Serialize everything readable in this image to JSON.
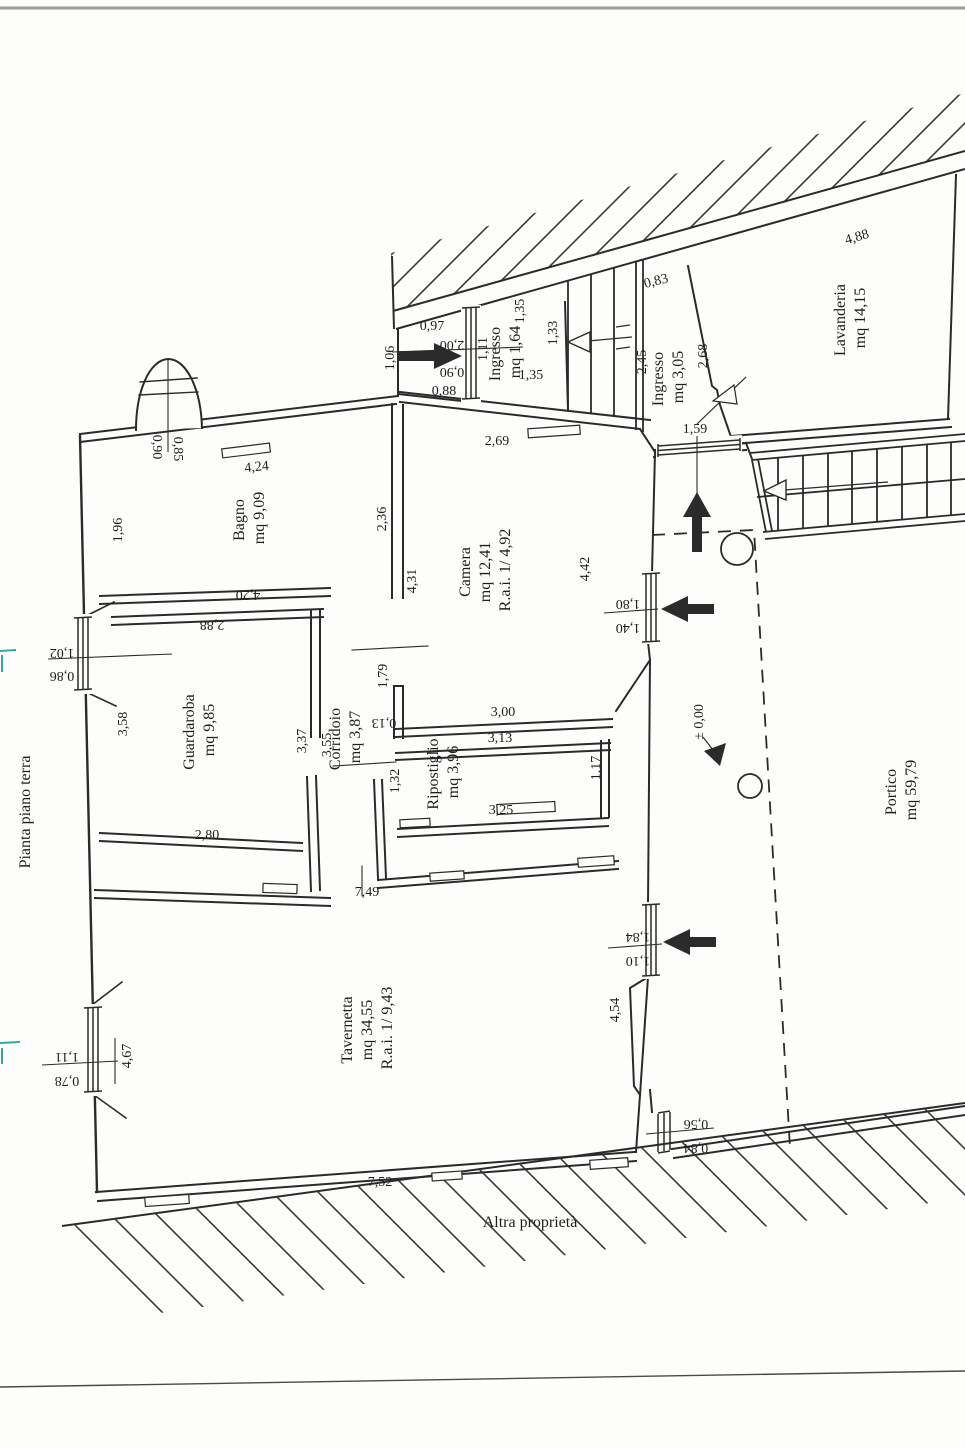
{
  "colors": {
    "ink": "#2b2b2b",
    "paper": "#fdfdfb",
    "teal_mark": "#35a8a1"
  },
  "title": "Pianta piano terra",
  "site_label": "Altra proprietà",
  "level_marker": "± 0,00",
  "rooms": {
    "ingresso_small": {
      "name": "Ingresso",
      "area": "mq 1,64"
    },
    "ingresso_main": {
      "name": "Ingresso",
      "area": "mq 3,05"
    },
    "lavanderia": {
      "name": "Lavanderia",
      "area": "mq 14,15"
    },
    "bagno": {
      "name": "Bagno",
      "area": "mq 9,09"
    },
    "camera": {
      "name": "Camera",
      "area": "mq 12,41",
      "rai": "R.a.i. 1/ 4,92"
    },
    "guardaroba": {
      "name": "Guardaroba",
      "area": "mq 9,85"
    },
    "corridoio": {
      "name": "Corridoio",
      "area": "mq 3,87"
    },
    "ripostiglio": {
      "name": "Ripostiglio",
      "area": "mq 3,96"
    },
    "tavernetta": {
      "name": "Tavernetta",
      "area": "mq 34,55",
      "rai": "R.a.i. 1/ 9,43"
    },
    "portico": {
      "name": "Portico",
      "area": "mq 59,79"
    }
  },
  "dims": {
    "entry_097": "0,97",
    "entry_088": "0,88",
    "entry_door_200": "2,00",
    "entry_door_090": "0,90",
    "entry_111": "1,11",
    "entry_106": "1,06",
    "ingresso_135_top": "1,35",
    "ingresso_135_bottom": "1,35",
    "stair_133": "1,33",
    "stair_083": "0,83",
    "ingresso_245": "2,45",
    "ingresso_268": "2,68",
    "portico_door_159": "1,59",
    "lavanderia_488": "4,88",
    "bagno_bay_090": "0,90",
    "bagno_bay_085": "0,85",
    "bagno_424": "4,24",
    "bagno_196": "1,96",
    "bagno_420": "4,20",
    "camera_236": "2,36",
    "camera_269": "2,69",
    "camera_431": "4,31",
    "camera_442": "4,42",
    "camera_300": "3,00",
    "camera_win_180": "1,80",
    "camera_win_140": "1,40",
    "guardaroba_288": "2,88",
    "guardaroba_win_102": "1,02",
    "guardaroba_win_086": "0,86",
    "guardaroba_358": "3,58",
    "guardaroba_337": "3,37",
    "guardaroba_280": "2,80",
    "corridoio_355": "3,55",
    "corridoio_179": "1,79",
    "corridoio_013": "0,13",
    "corridoio_132": "1,32",
    "ripostiglio_313": "3,13",
    "ripostiglio_325": "3,25",
    "ripostiglio_117": "1,17",
    "tavernetta_749": "7,49",
    "tavernetta_752": "7,52",
    "tavernetta_467": "4,67",
    "tav_win_111": "1,11",
    "tav_win_078": "0,78",
    "tav_win_184": "1,84",
    "tav_win_110": "1,10",
    "portico_454": "4,54",
    "portico_win_056": "0,56",
    "portico_win_084": "0,84"
  }
}
